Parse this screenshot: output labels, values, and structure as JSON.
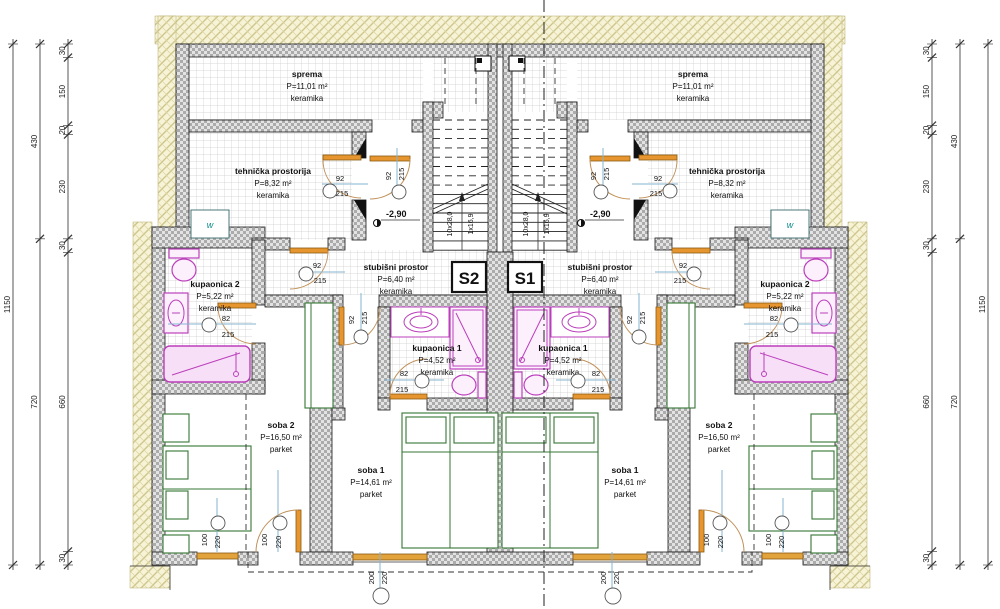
{
  "units": {
    "s2": "S2",
    "s1": "S1"
  },
  "rooms": {
    "sprema": {
      "name": "sprema",
      "area": "P=11,01 m²",
      "floor": "keramika"
    },
    "tehnicka": {
      "name": "tehnička prostorija",
      "area": "P=8,32 m²",
      "floor": "keramika"
    },
    "kupaonica2": {
      "name": "kupaonica 2",
      "area": "P=5,22 m²",
      "floor": "keramika"
    },
    "stubisni": {
      "name": "stubišni prostor",
      "area": "P=6,40 m²",
      "floor": "keramika"
    },
    "kupaonica1": {
      "name": "kupaonica 1",
      "area": "P=4,52 m²",
      "floor": "keramika"
    },
    "soba2": {
      "name": "soba 2",
      "area": "P=16,50 m²",
      "floor": "parket"
    },
    "soba1": {
      "name": "soba 1",
      "area": "P=14,61 m²",
      "floor": "parket"
    }
  },
  "doors": {
    "d92": {
      "w": "92",
      "h": "215"
    },
    "d82": {
      "w": "82",
      "h": "215"
    }
  },
  "windows": {
    "w100": {
      "w": "100",
      "h": "220"
    },
    "w200": {
      "w": "200",
      "h": "220"
    }
  },
  "stairs": {
    "treads": "10x28,0",
    "riser": "1x16,9"
  },
  "level_mark": "-2,90",
  "boiler": "w",
  "dimensions": {
    "inner": [
      "30",
      "150",
      "20",
      "230",
      "30",
      "660",
      "30"
    ],
    "middle": [
      "430",
      "720"
    ],
    "total": [
      "1150"
    ]
  }
}
